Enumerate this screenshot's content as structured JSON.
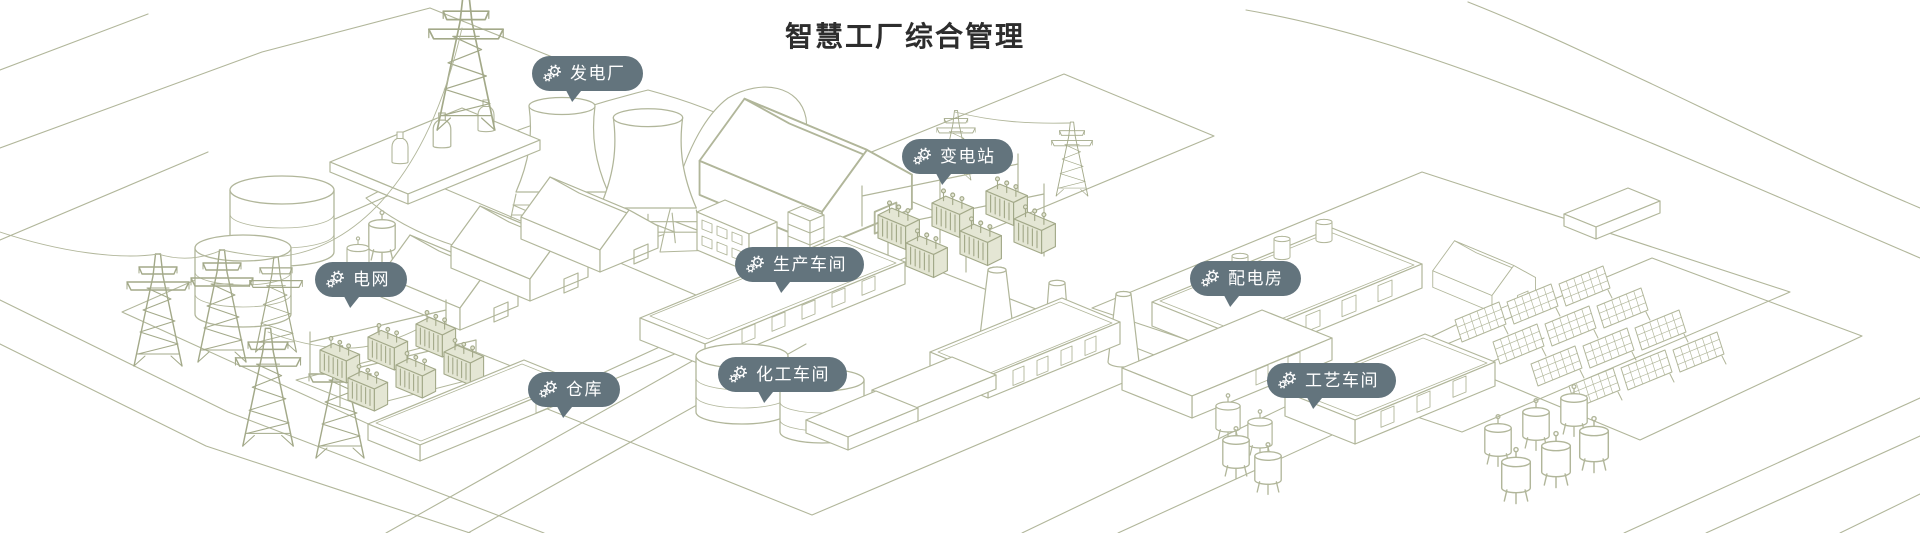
{
  "page": {
    "title": "智慧工厂综合管理"
  },
  "theme": {
    "badge_color": "#63747D",
    "badge_text_color": "#FFFFFF",
    "line_color": "#B1B69A",
    "line_color_dark": "#A3A989",
    "title_color": "#2D2D2D",
    "background_color": "#FFFFFF"
  },
  "markers": [
    {
      "id": "power-plant",
      "label": "发电厂",
      "icon": "gears-icon",
      "x": 532,
      "y": 56
    },
    {
      "id": "substation",
      "label": "变电站",
      "icon": "gears-icon",
      "x": 902,
      "y": 139
    },
    {
      "id": "power-grid",
      "label": "电网",
      "icon": "gears-icon",
      "x": 315,
      "y": 262
    },
    {
      "id": "production-workshop",
      "label": "生产车间",
      "icon": "gears-icon",
      "x": 735,
      "y": 247
    },
    {
      "id": "distribution-room",
      "label": "配电房",
      "icon": "gears-icon",
      "x": 1190,
      "y": 261
    },
    {
      "id": "warehouse",
      "label": "仓库",
      "icon": "gears-icon",
      "x": 528,
      "y": 372
    },
    {
      "id": "chemical-workshop",
      "label": "化工车间",
      "icon": "gears-icon",
      "x": 718,
      "y": 357
    },
    {
      "id": "process-workshop",
      "label": "工艺车间",
      "icon": "gears-icon",
      "x": 1267,
      "y": 363
    }
  ],
  "illustration": {
    "description": "Isometric sage-green line drawing of a smart factory campus",
    "elements": [
      "transmission-towers",
      "power-plant-cooling-towers",
      "substation-transformers",
      "storage-tanks",
      "workshop-sheds",
      "production-building",
      "warehouse-buildings",
      "chimneys",
      "solar-panel-array",
      "distribution-buildings",
      "small-tank-clusters",
      "roads"
    ]
  }
}
